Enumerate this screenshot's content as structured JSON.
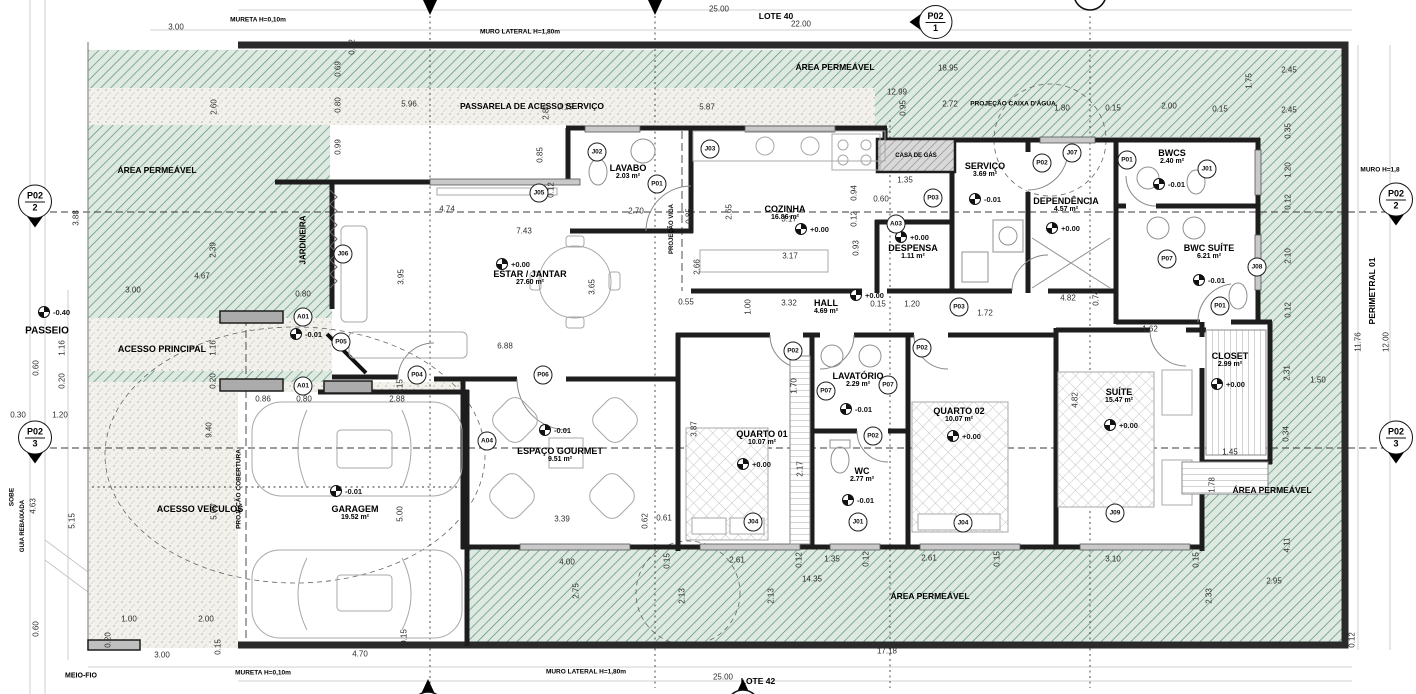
{
  "site": {
    "lote_top": "LOTE 40",
    "lote_bottom": "LOTE 42",
    "area_permeavel": "ÁREA PERMEÁVEL",
    "passarela": "PASSARELA DE ACESSO SERVIÇO",
    "passeio": "PASSEIO",
    "acesso_principal": "ACESSO PRINCIPAL",
    "acesso_veiculos": "ACESSO VEÍCULOS",
    "jardineira": "JARDINEIRA",
    "projecao_cobertura": "PROJEÇÃO COBERTURA",
    "projecao_viga": "PROJEÇÃO VIGA",
    "projecao_caixa_dagua": "PROJEÇÃO CAIXA D'ÁGUA",
    "casa_de_gas": "CASA DE GÁS",
    "perimetral": "PERIMETRAL 01",
    "guia_rebaixada": "GUIA REBAIXADA",
    "sobe": "SOBE",
    "meio_fio": "MEIO-FIO",
    "mureta": "MURETA H=0,10m",
    "muro_lateral": "MURO LATERAL H=1,80m",
    "muro_direito": "MURO H=1,8"
  },
  "colors": {
    "hatch_green_line": "#5a9278",
    "hatch_green_bg": "#dde9e1",
    "stipple_bg": "#f3f1ec",
    "wall": "#1d1d1d"
  },
  "rooms": [
    {
      "name": "ESTAR / JANTAR",
      "area": "27.60 m²",
      "x": 530,
      "y": 278
    },
    {
      "name": "LAVABO",
      "area": "2.03 m²",
      "x": 628,
      "y": 172
    },
    {
      "name": "COZINHA",
      "area": "16.86 m²",
      "x": 785,
      "y": 213
    },
    {
      "name": "DESPENSA",
      "area": "1.11 m²",
      "x": 913,
      "y": 252
    },
    {
      "name": "HALL",
      "area": "4.69 m²",
      "x": 826,
      "y": 307
    },
    {
      "name": "SERVIÇO",
      "area": "3.69 m²",
      "x": 985,
      "y": 170
    },
    {
      "name": "DEPENDÊNCIA",
      "area": "4.57 m²",
      "x": 1066,
      "y": 205
    },
    {
      "name": "BWCS",
      "area": "2.40 m²",
      "x": 1172,
      "y": 157
    },
    {
      "name": "BWC SUÍTE",
      "area": "6.21 m²",
      "x": 1209,
      "y": 252
    },
    {
      "name": "CLOSET",
      "area": "2.99 m²",
      "x": 1230,
      "y": 360
    },
    {
      "name": "SUÍTE",
      "area": "15.47 m²",
      "x": 1119,
      "y": 396
    },
    {
      "name": "QUARTO 01",
      "area": "10.07 m²",
      "x": 762,
      "y": 438
    },
    {
      "name": "QUARTO 02",
      "area": "10.07 m²",
      "x": 959,
      "y": 415
    },
    {
      "name": "LAVATÓRIO",
      "area": "2.29 m²",
      "x": 858,
      "y": 380
    },
    {
      "name": "WC",
      "area": "2.77 m²",
      "x": 862,
      "y": 475
    },
    {
      "name": "ESPAÇO GOURMET",
      "area": "9.51 m²",
      "x": 560,
      "y": 455
    },
    {
      "name": "GARAGEM",
      "area": "19.52 m²",
      "x": 355,
      "y": 513
    }
  ],
  "levels": [
    {
      "v": "+0.00",
      "x": 496,
      "y": 264
    },
    {
      "v": "+0.00",
      "x": 795,
      "y": 229
    },
    {
      "v": "+0.00",
      "x": 850,
      "y": 295
    },
    {
      "v": "+0.00",
      "x": 895,
      "y": 237
    },
    {
      "v": "-0.01",
      "x": 969,
      "y": 199
    },
    {
      "v": "+0.00",
      "x": 1046,
      "y": 228
    },
    {
      "v": "-0.01",
      "x": 1153,
      "y": 184
    },
    {
      "v": "-0.01",
      "x": 1193,
      "y": 280
    },
    {
      "v": "+0.00",
      "x": 1211,
      "y": 384
    },
    {
      "v": "+0.00",
      "x": 1104,
      "y": 425
    },
    {
      "v": "+0.00",
      "x": 737,
      "y": 464
    },
    {
      "v": "+0.00",
      "x": 947,
      "y": 436
    },
    {
      "v": "-0.01",
      "x": 840,
      "y": 409
    },
    {
      "v": "-0.01",
      "x": 842,
      "y": 500
    },
    {
      "v": "-0.01",
      "x": 539,
      "y": 430
    },
    {
      "v": "-0.01",
      "x": 330,
      "y": 491
    },
    {
      "v": "-0.40",
      "x": 38,
      "y": 312
    },
    {
      "v": "-0.01",
      "x": 290,
      "y": 334
    }
  ],
  "dims": [
    [
      "3.00",
      176,
      27,
      0
    ],
    [
      "25.00",
      719,
      9,
      0
    ],
    [
      "22.00",
      801,
      24,
      0
    ],
    [
      "18.95",
      948,
      68,
      0
    ],
    [
      "12.99",
      897,
      92,
      0
    ],
    [
      "5.96",
      409,
      104,
      0
    ],
    [
      "0.15",
      565,
      107,
      0
    ],
    [
      "5.87",
      707,
      107,
      0
    ],
    [
      "0.95",
      903,
      108,
      1
    ],
    [
      "2.72",
      950,
      104,
      0
    ],
    [
      "1.80",
      1062,
      108,
      0
    ],
    [
      "0.15",
      1113,
      108,
      0
    ],
    [
      "2.00",
      1169,
      106,
      0
    ],
    [
      "0.15",
      1220,
      109,
      0
    ],
    [
      "2.45",
      1289,
      70,
      0
    ],
    [
      "1.75",
      1249,
      81,
      1
    ],
    [
      "2.45",
      1289,
      110,
      0
    ],
    [
      "2.60",
      214,
      107,
      1
    ],
    [
      "0.69",
      338,
      69,
      1
    ],
    [
      "0.80",
      338,
      105,
      1
    ],
    [
      "0.99",
      338,
      147,
      1
    ],
    [
      "0.12",
      352,
      47,
      1
    ],
    [
      "2.80",
      546,
      112,
      1
    ],
    [
      "0.85",
      540,
      155,
      1
    ],
    [
      "0.12",
      551,
      190,
      1
    ],
    [
      "3.88",
      76,
      218,
      1
    ],
    [
      "2.39",
      213,
      250,
      1
    ],
    [
      "4.67",
      202,
      276,
      0
    ],
    [
      "3.00",
      133,
      290,
      0
    ],
    [
      "1.16",
      62,
      348,
      1
    ],
    [
      "1.16",
      213,
      348,
      1
    ],
    [
      "0.60",
      36,
      368,
      1
    ],
    [
      "0.20",
      213,
      381,
      1
    ],
    [
      "0.20",
      62,
      381,
      1
    ],
    [
      "0.30",
      18,
      415,
      0
    ],
    [
      "1.20",
      60,
      415,
      0
    ],
    [
      "9.40",
      209,
      430,
      1
    ],
    [
      "4.63",
      33,
      506,
      1
    ],
    [
      "5.15",
      72,
      521,
      1
    ],
    [
      "0.60",
      36,
      629,
      1
    ],
    [
      "1.00",
      129,
      619,
      0
    ],
    [
      "2.00",
      206,
      619,
      0
    ],
    [
      "0.20",
      108,
      640,
      1
    ],
    [
      "3.00",
      162,
      655,
      0
    ],
    [
      "0.15",
      218,
      647,
      1
    ],
    [
      "4.70",
      360,
      654,
      0
    ],
    [
      "0.15",
      404,
      637,
      1
    ],
    [
      "4.74",
      447,
      209,
      0
    ],
    [
      "7.43",
      524,
      231,
      0
    ],
    [
      "2.70",
      636,
      211,
      0
    ],
    [
      "0.85",
      689,
      216,
      1
    ],
    [
      "2.65",
      729,
      212,
      1
    ],
    [
      "3.95",
      401,
      277,
      1
    ],
    [
      "3.65",
      592,
      287,
      1
    ],
    [
      "6.88",
      505,
      346,
      0
    ],
    [
      "0.86",
      263,
      399,
      0
    ],
    [
      "0.80",
      304,
      399,
      0
    ],
    [
      "2.88",
      397,
      399,
      0
    ],
    [
      "0.80",
      303,
      294,
      0
    ],
    [
      "0.15",
      400,
      387,
      1
    ],
    [
      "3.17",
      789,
      219,
      0
    ],
    [
      "3.17",
      790,
      256,
      0
    ],
    [
      "0.94",
      854,
      193,
      1
    ],
    [
      "0.12",
      854,
      219,
      1
    ],
    [
      "0.93",
      856,
      248,
      1
    ],
    [
      "1.35",
      905,
      180,
      0
    ],
    [
      "0.60",
      881,
      199,
      0
    ],
    [
      "2.66",
      697,
      267,
      1
    ],
    [
      "0.55",
      686,
      302,
      0
    ],
    [
      "1.00",
      748,
      307,
      1
    ],
    [
      "3.32",
      789,
      303,
      0
    ],
    [
      "0.15",
      878,
      304,
      0
    ],
    [
      "1.20",
      912,
      304,
      0
    ],
    [
      "1.72",
      985,
      313,
      0
    ],
    [
      "4.82",
      1068,
      298,
      0
    ],
    [
      "0.74",
      1096,
      298,
      1
    ],
    [
      "1.62",
      1150,
      329,
      0
    ],
    [
      "4.82",
      1075,
      400,
      1
    ],
    [
      "3.87",
      694,
      429,
      1
    ],
    [
      "1.70",
      794,
      386,
      1
    ],
    [
      "2.17",
      800,
      469,
      1
    ],
    [
      "3.39",
      562,
      519,
      0
    ],
    [
      "0.62",
      645,
      521,
      1
    ],
    [
      "0.61",
      664,
      518,
      0
    ],
    [
      "4.00",
      567,
      562,
      0
    ],
    [
      "0.15",
      667,
      561,
      1
    ],
    [
      "2.61",
      737,
      560,
      0
    ],
    [
      "0.12",
      799,
      560,
      1
    ],
    [
      "1.35",
      832,
      559,
      0
    ],
    [
      "0.12",
      866,
      559,
      1
    ],
    [
      "2.61",
      929,
      558,
      0
    ],
    [
      "0.15",
      997,
      559,
      1
    ],
    [
      "14.35",
      812,
      579,
      0
    ],
    [
      "3.10",
      1113,
      559,
      0
    ],
    [
      "0.15",
      1196,
      560,
      1
    ],
    [
      "2.75",
      576,
      591,
      1
    ],
    [
      "2.13",
      682,
      596,
      1
    ],
    [
      "2.13",
      771,
      596,
      1
    ],
    [
      "17.18",
      887,
      651,
      0
    ],
    [
      "25.00",
      723,
      677,
      0
    ],
    [
      "5.00",
      214,
      512,
      1
    ],
    [
      "5.00",
      400,
      514,
      1
    ],
    [
      "0.35",
      1288,
      131,
      1
    ],
    [
      "1.20",
      1288,
      170,
      1
    ],
    [
      "0.12",
      1288,
      202,
      1
    ],
    [
      "2.10",
      1288,
      256,
      1
    ],
    [
      "0.12",
      1288,
      310,
      1
    ],
    [
      "2.31",
      1287,
      373,
      1
    ],
    [
      "1.50",
      1318,
      380,
      0
    ],
    [
      "0.34",
      1286,
      434,
      1
    ],
    [
      "1.45",
      1230,
      452,
      0
    ],
    [
      "1.78",
      1212,
      485,
      1
    ],
    [
      "4.11",
      1287,
      545,
      1
    ],
    [
      "2.95",
      1274,
      581,
      0
    ],
    [
      "2.33",
      1209,
      596,
      1
    ],
    [
      "0.12",
      1352,
      640,
      1
    ],
    [
      "11.76",
      1358,
      342,
      1
    ],
    [
      "12.00",
      1386,
      342,
      1
    ]
  ],
  "markers": [
    [
      "J02",
      597,
      152
    ],
    [
      "J03",
      710,
      149
    ],
    [
      "J05",
      539,
      193
    ],
    [
      "J06",
      343,
      254
    ],
    [
      "J07",
      1072,
      153
    ],
    [
      "J01",
      1207,
      169
    ],
    [
      "J08",
      1257,
      267
    ],
    [
      "J09",
      1115,
      513
    ],
    [
      "J04",
      753,
      522
    ],
    [
      "J04",
      963,
      523
    ],
    [
      "J01",
      858,
      522
    ],
    [
      "P01",
      657,
      184
    ],
    [
      "P01",
      1127,
      160
    ],
    [
      "P01",
      1220,
      306
    ],
    [
      "P02",
      1042,
      163
    ],
    [
      "P02",
      793,
      351
    ],
    [
      "P02",
      873,
      436
    ],
    [
      "P02",
      922,
      348
    ],
    [
      "P03",
      933,
      198
    ],
    [
      "P03",
      959,
      307
    ],
    [
      "P04",
      417,
      375
    ],
    [
      "P05",
      341,
      342
    ],
    [
      "P06",
      543,
      375
    ],
    [
      "P07",
      1167,
      259
    ],
    [
      "P07",
      826,
      391
    ],
    [
      "P07",
      888,
      385
    ],
    [
      "A01",
      303,
      317
    ],
    [
      "A01",
      303,
      386
    ],
    [
      "A03",
      896,
      224
    ],
    [
      "A04",
      487,
      441
    ]
  ],
  "section_markers": [
    {
      "t": "P02",
      "n": "2",
      "x": 35,
      "y": 206,
      "dir": "down"
    },
    {
      "t": "P02",
      "n": "3",
      "x": 35,
      "y": 442,
      "dir": "down"
    },
    {
      "t": "P02",
      "n": "2",
      "x": 1396,
      "y": 204,
      "dir": "down"
    },
    {
      "t": "P02",
      "n": "3",
      "x": 1396,
      "y": 442,
      "dir": "down"
    },
    {
      "t": "P02",
      "n": "1",
      "x": 931,
      "y": 22,
      "dir": "left"
    }
  ]
}
